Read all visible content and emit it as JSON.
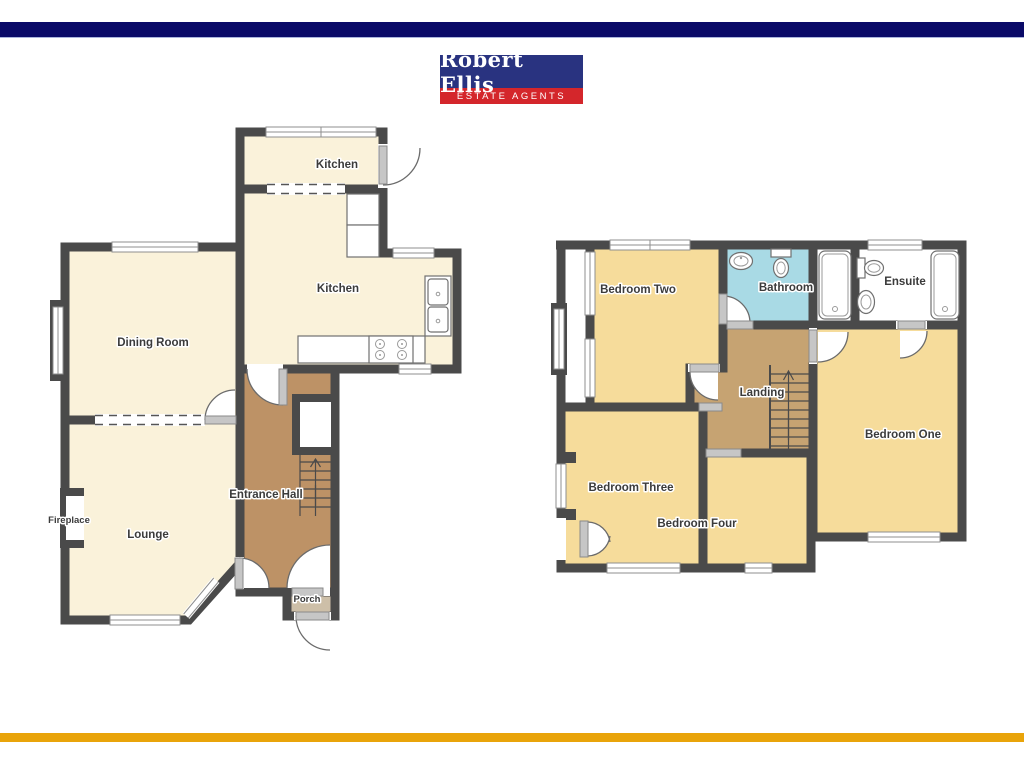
{
  "brand": {
    "logo_name": "Robert Ellis",
    "logo_tagline": "ESTATE AGENTS",
    "top_bar_color": "#0a0a68",
    "logo_bg": "#293380",
    "tagline_bg": "#d4262b",
    "accent_bar_color": "#e9a40a"
  },
  "ground_floor": {
    "rooms": {
      "kitchen_top": "Kitchen",
      "kitchen": "Kitchen",
      "dining_room": "Dining Room",
      "lounge": "Lounge",
      "entrance_hall": "Entrance Hall",
      "porch": "Porch"
    },
    "annotations": {
      "fireplace": "Fireplace"
    }
  },
  "first_floor": {
    "rooms": {
      "bedroom_one": "Bedroom One",
      "bedroom_two": "Bedroom Two",
      "bedroom_three": "Bedroom Three",
      "bedroom_four": "Bedroom Four",
      "bathroom": "Bathroom",
      "ensuite": "Ensuite",
      "landing": "Landing"
    }
  },
  "palette": {
    "wall": "#4a4a4a",
    "room_cream": "#faf2da",
    "room_yellow": "#f6dc9b",
    "hall_brown": "#bd9266",
    "landing_brown": "#c6a372",
    "bathroom_blue": "#a9dae5",
    "porch_tan": "#cdbfa8",
    "window_gray": "#b3b3b3",
    "door_gray": "#c6c6c6"
  }
}
